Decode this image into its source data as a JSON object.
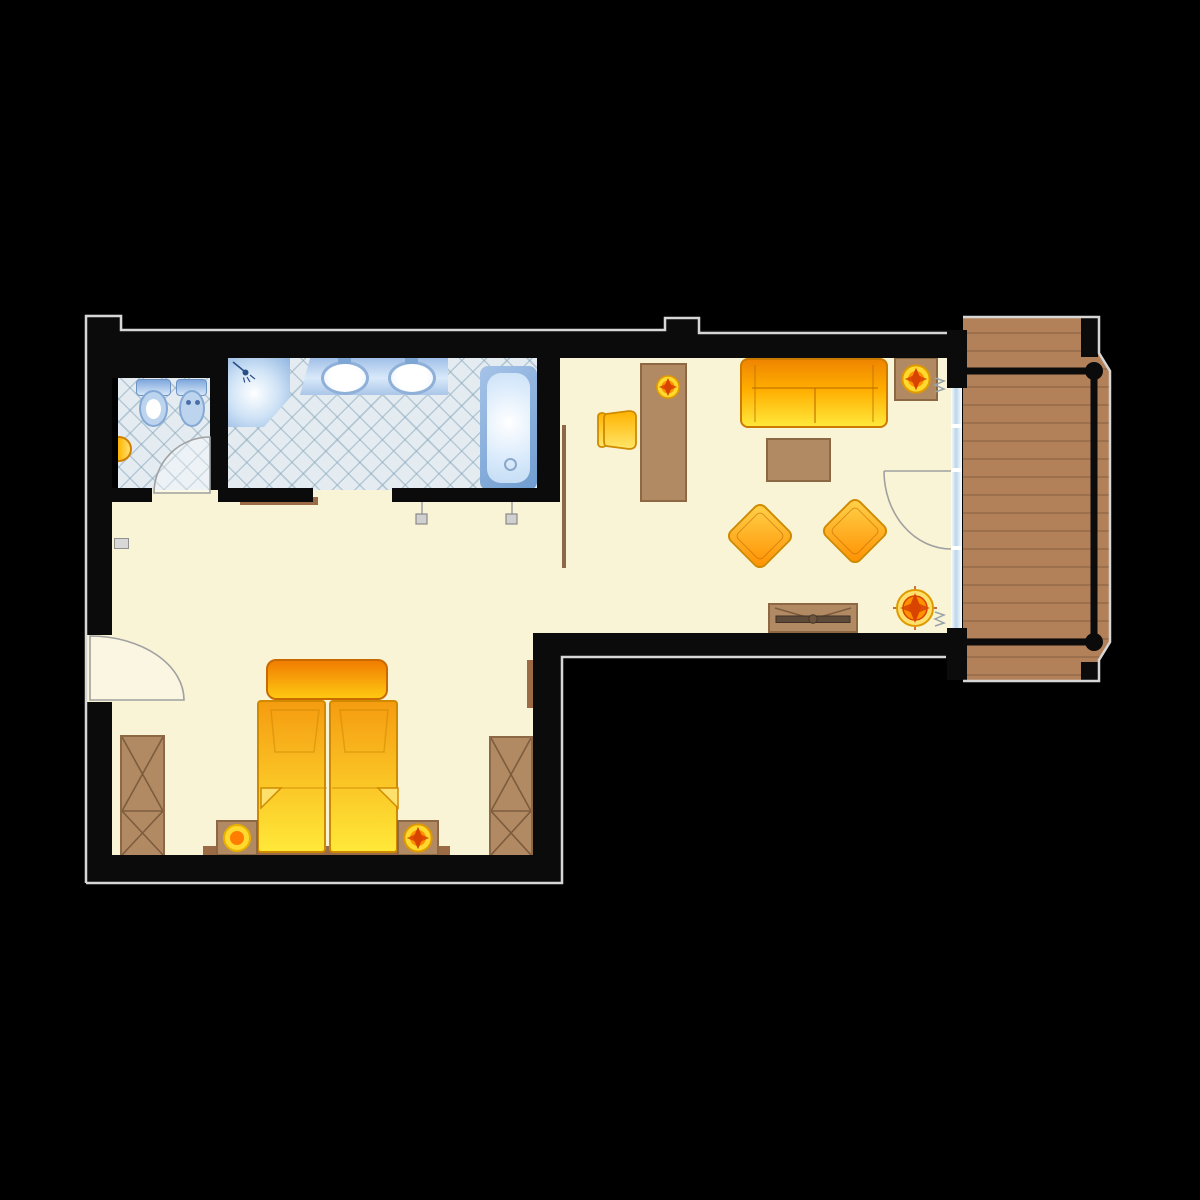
{
  "document": {
    "kind": "hotel-suite-floor-plan",
    "visible_text": []
  },
  "rooms": [
    {
      "id": "wc",
      "contents": [
        "toilet",
        "bidet",
        "corner-basin",
        "tiled-floor",
        "door"
      ]
    },
    {
      "id": "bathroom",
      "contents": [
        "shower",
        "double-sink-vanity",
        "bathtub",
        "tiled-floor",
        "door"
      ]
    },
    {
      "id": "bedroom",
      "contents": [
        "double-bed",
        "headboard-bench",
        "nightstand-left-with-lamp",
        "nightstand-right-with-plant",
        "wardrobe-left",
        "wardrobe-right",
        "wall-shelf",
        "sideboard-shelves",
        "entry-door"
      ]
    },
    {
      "id": "living-room",
      "contents": [
        "desk",
        "desk-chair",
        "desk-plant",
        "sofa",
        "side-table-with-plant",
        "coffee-table",
        "armchair-1",
        "armchair-2",
        "tv-sideboard",
        "floor-plant",
        "room-divider",
        "balcony-door",
        "window-glass-wall"
      ]
    },
    {
      "id": "balcony",
      "contents": [
        "wood-deck",
        "railing",
        "railing-posts"
      ]
    }
  ],
  "colors": {
    "background": "#000000",
    "wall": "#0b0b0b",
    "outline": "#d6d6d6",
    "floor": "#f9f4d6",
    "tile_base": "#e4ecf1",
    "fixture_blue": "#7ba6d8",
    "fixture_light": "#dcecfb",
    "wood": "#b18a63",
    "wood_dark": "#8c6844",
    "deck": "#b28059",
    "deck_line": "#9c6f4d",
    "orange_deep": "#ef8500",
    "orange_mid": "#ffae00",
    "yellow": "#ffe83a",
    "accent_red": "#d84400"
  }
}
